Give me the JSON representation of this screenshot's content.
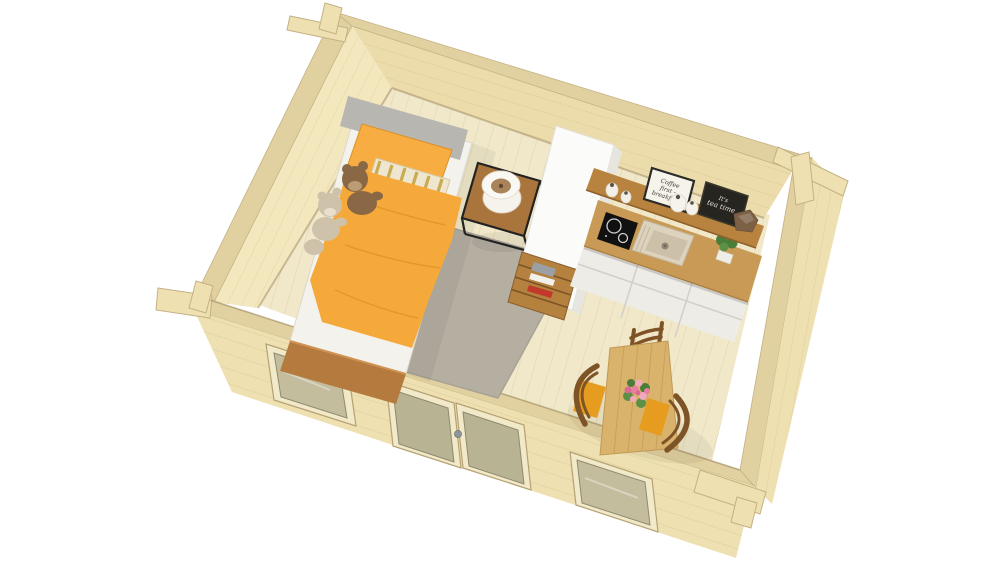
{
  "scene": {
    "type": "3d-isometric-interior-render",
    "description": "Bird's-eye 3D cutaway render of a one-room wooden log cabin containing a bedroom corner, a kitchenette and a dining area, on a white background",
    "background": "#ffffff",
    "rooms": [
      "bedroom",
      "kitchenette",
      "dining-area"
    ]
  },
  "signs": {
    "coffee_sign": {
      "line1": "Coffee",
      "line2": "first -",
      "line3": "breakfast"
    },
    "tea_board": {
      "line1": "It's",
      "line2": "tea time"
    }
  },
  "objects": {
    "bed": "single bed with orange duvet, orange pillow, striped pillow and grey headboard",
    "teddy_bears": "two plush teddy bears on the bed",
    "nightstand": "black metal frame side table with white cylinder lamp",
    "rug": "grey area rug",
    "tall_cabinet": "tall white cabinet room divider",
    "bookshelf": "low wooden open shelf with books",
    "kitchen": "kitchenette with induction hob, sink, wall shelf, decor signs and white drawer units",
    "dining": "wooden dining table with flower bouquet and three chairs with orange cushions",
    "cabin": "log cabin walls with corner joints, two windows and a glazed double door"
  },
  "colors": {
    "wall_wood": "#eee0b0",
    "wall_wood_light": "#f3e7bd",
    "wall_wood_dark": "#ecdcab",
    "wall_rim": "#e2d1a0",
    "wall_edge": "#c4b183",
    "floor_wood": "#f1e8ca",
    "window_frame": "#f2e9c9",
    "glass": "#c3bd9d",
    "door_glass": "#b8b392",
    "handle_metal": "#8f969b",
    "rug": "#b5afa2",
    "mattress": "#f4f2ec",
    "headboard": "#b8b6b0",
    "duvet": "#f6a93b",
    "pillow": "#f8ad42",
    "stripe_base": "#efe6cf",
    "stripe_gold": "#c8ab52",
    "bed_frame": "#b47a3e",
    "teddy_brown": "#8a6845",
    "teddy_brown_muzzle": "#bb9c74",
    "teddy_cream": "#cfc2ab",
    "teddy_cream_muzzle": "#e8dfcc",
    "nightstand_top": "#aa753c",
    "metal_black": "#222222",
    "lamp_white": "#f6f3ec",
    "lamp_inner": "#a9835a",
    "wardrobe_white": "#fbfbfa",
    "wardrobe_side": "#e6e5e0",
    "bookshelf_wood": "#b5813f",
    "shelf_board": "#b8833f",
    "counter_wood": "#c89a55",
    "cooktop_black": "#111111",
    "burner_ring": "#d0d0d0",
    "sink_rim": "#ddd2bd",
    "sink_basin": "#cdc0a8",
    "cabinet_white": "#eeece7",
    "sign_white": "#f6f3ea",
    "sign_frame": "#2a2a28",
    "sign_ink": "#3a3a3a",
    "chalkboard": "#26251f",
    "chalk_text": "#e8e4da",
    "stone_brown": "#7d6147",
    "plant_green": "#4a7d3a",
    "plant_green_light": "#5d8f46",
    "pot_white": "#f0ede6",
    "table_wood": "#d9b36b",
    "chair_wood": "#7e5426",
    "cushion_orange": "#e59c1f",
    "flower_pink": "#e87fa0",
    "flower_pink_light": "#f2a9c0",
    "flower_pink_dark": "#d96b92",
    "book_red": "#c0392b",
    "book_gray": "#9aa0a4",
    "book_white": "#f2f0ea"
  }
}
